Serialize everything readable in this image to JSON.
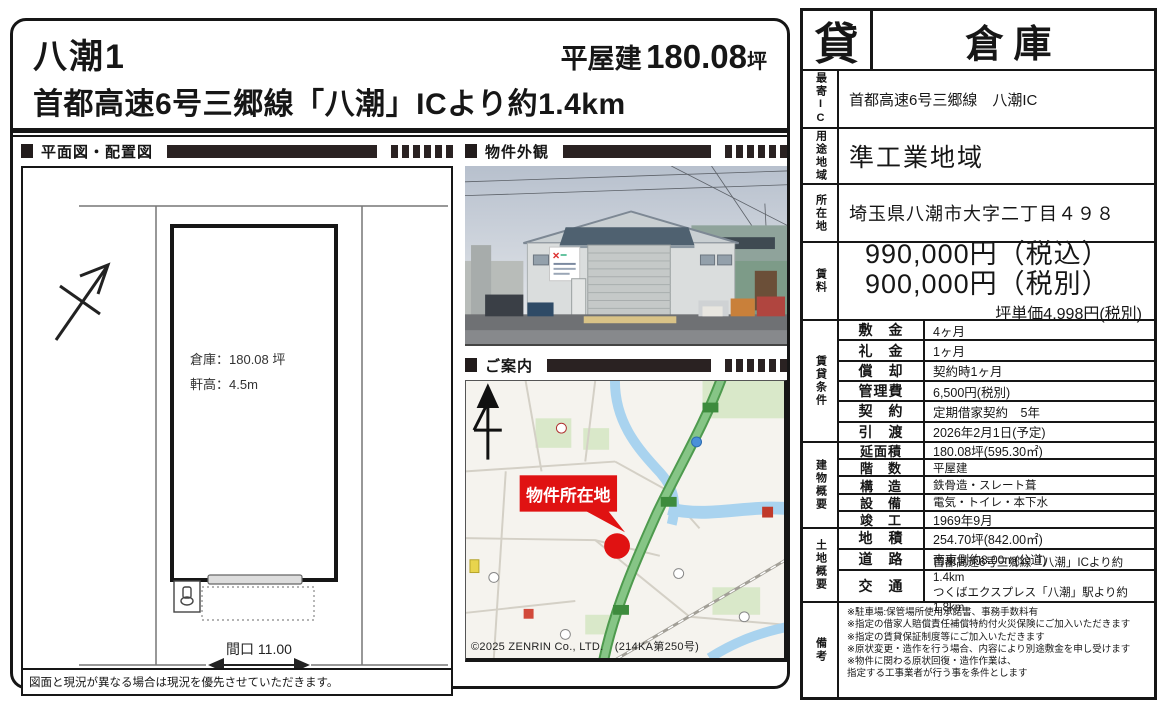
{
  "title": {
    "name": "八潮1",
    "size_label": "平屋建",
    "size_value": "180.08",
    "size_unit": "坪",
    "subtitle": "首都高速6号三郷線「八潮」ICより約1.4km"
  },
  "sections": {
    "plan": "平面図・配置図",
    "photo": "物件外観",
    "map": "ご案内"
  },
  "plan": {
    "warehouse_area": "倉庫：180.08 坪",
    "eaves_height": "軒高：4.5m",
    "frontage": "間口 11.00",
    "footnote": "図面と現況が異なる場合は現況を優先させていただきます。"
  },
  "map": {
    "marker_label": "物件所在地",
    "copyright": "©2025 ZENRIN Co., LTD.　(214KA第250号)"
  },
  "colors": {
    "accent_red": "#e01212",
    "highway_green": "#86c586",
    "river_blue": "#a9d3ef",
    "ink": "#161616"
  },
  "table": {
    "type_badge": "貸",
    "property_type": "倉庫",
    "nearest_ic": {
      "label": "最寄IC",
      "value": "首都高速6号三郷線　八潮IC"
    },
    "zoning": {
      "label": "用途地域",
      "value": "準工業地域"
    },
    "address": {
      "label": "所在地",
      "value": "埼玉県八潮市大字二丁目４９８"
    },
    "rent": {
      "label": "賃料",
      "line1": "990,000円（税込）",
      "line2": "900,000円（税別）",
      "unit_price": "坪単価4,998円(税別)"
    },
    "lease": {
      "label": "賃貸条件",
      "items": [
        {
          "k": "敷　金",
          "v": "4ヶ月"
        },
        {
          "k": "礼　金",
          "v": "1ヶ月"
        },
        {
          "k": "償　却",
          "v": "契約時1ヶ月"
        },
        {
          "k": "管理費",
          "v": "6,500円(税別)"
        },
        {
          "k": "契　約",
          "v": "定期借家契約　5年"
        },
        {
          "k": "引　渡",
          "v": "2026年2月1日(予定)"
        }
      ]
    },
    "building": {
      "label": "建物概要",
      "items": [
        {
          "k": "延面積",
          "v": "180.08坪(595.30㎡)"
        },
        {
          "k": "階　数",
          "v": "平屋建"
        },
        {
          "k": "構　造",
          "v": "鉄骨造・スレート葺"
        },
        {
          "k": "設　備",
          "v": "電気・トイレ・本下水"
        },
        {
          "k": "竣　工",
          "v": "1969年9月"
        }
      ]
    },
    "land": {
      "label": "土地概要",
      "items": [
        {
          "k": "地　積",
          "v": "254.70坪(842.00㎡)"
        },
        {
          "k": "道　路",
          "v": "南東側約8.00m(公道)"
        }
      ],
      "access": {
        "k": "交　通",
        "v1": "首都高速6号三郷線「八潮」ICより約1.4km",
        "v2": "つくばエクスプレス「八潮」駅より約1.8km"
      }
    },
    "notes": {
      "label": "備考",
      "lines": [
        "※駐車場:保管場所使用承諾書、事務手数料有",
        "※指定の借家人賠償責任補償特約付火災保険にご加入いただきます",
        "※指定の賃貸保証制度等にご加入いただきます",
        "※原状変更・造作を行う場合、内容により別途敷金を申し受けます",
        "※物件に関わる原状回復・造作作業は、",
        "指定する工事業者が行う事を条件とします"
      ]
    }
  }
}
